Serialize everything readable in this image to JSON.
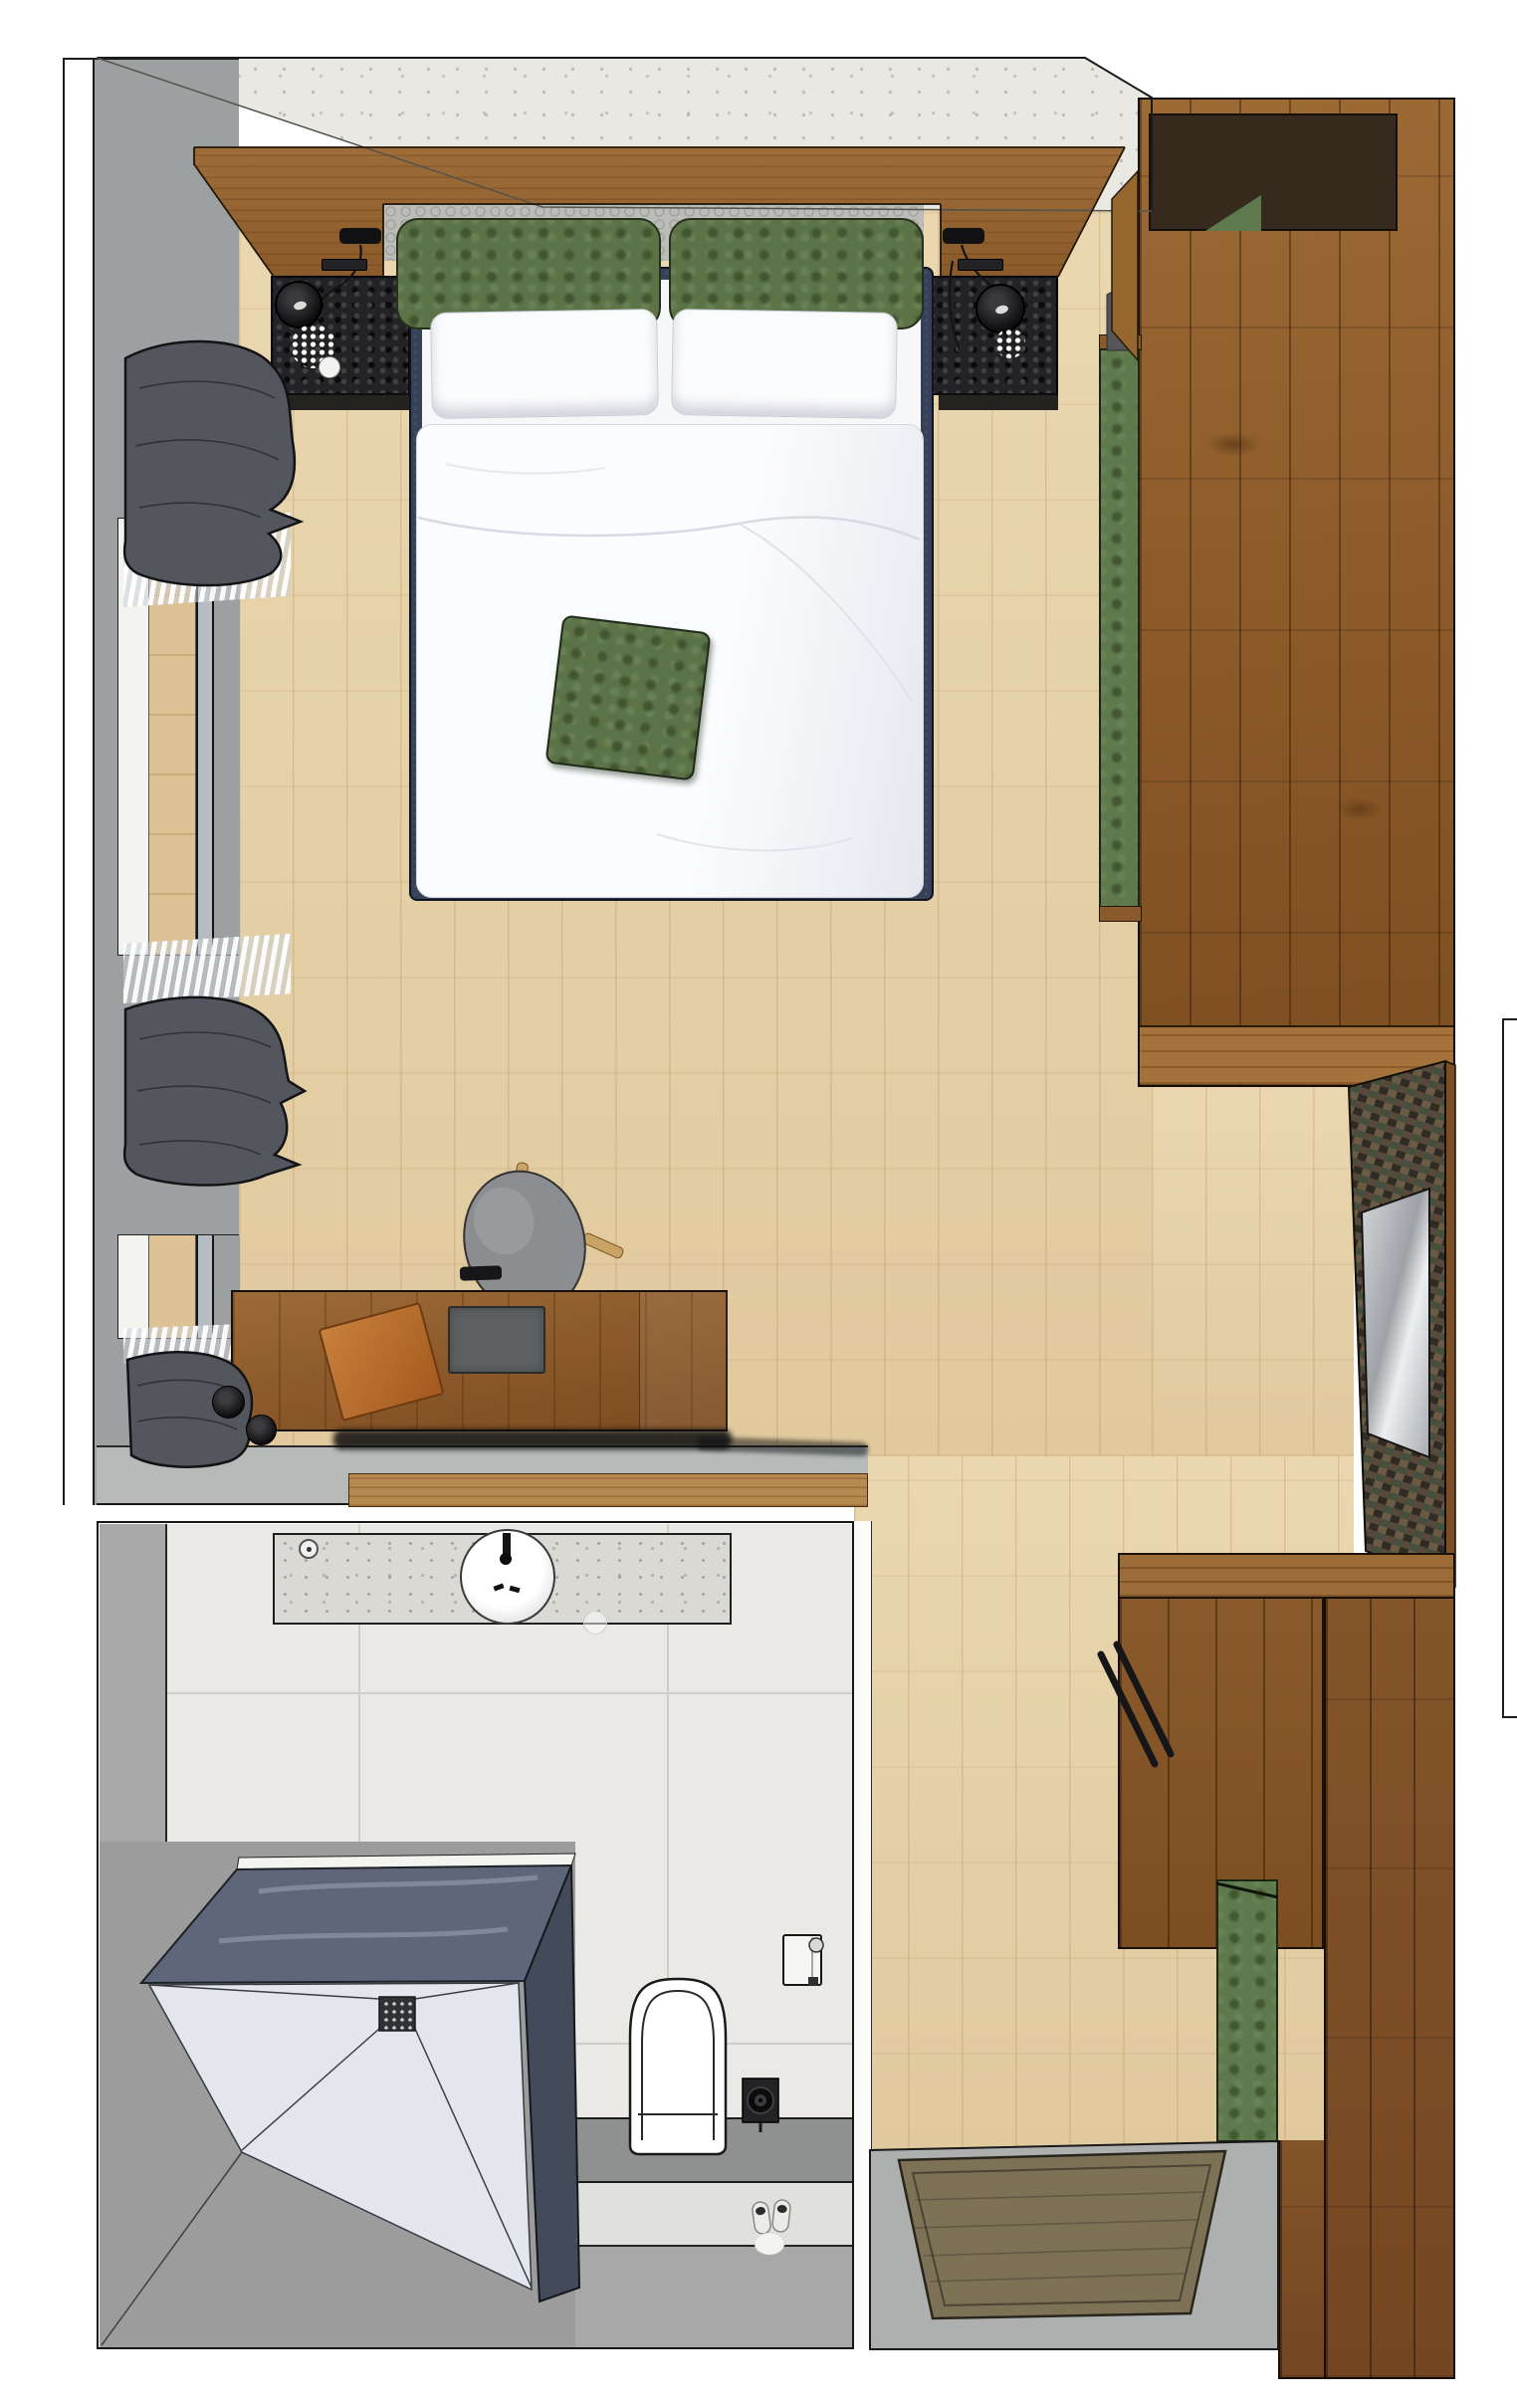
{
  "title": "hotel-guest-room-top-view-rendering",
  "colors": {
    "floor": "#e6d1a8",
    "concrete": "#eae8e2",
    "wall_gray": "#9da0a1",
    "outline": "#1c1c1c",
    "headboard_wood": "#96662f",
    "wardrobe_wood": "#91602f",
    "dark_wood": "#7a4c22",
    "desk_wood": "#8f5d2c",
    "coal": "#232326",
    "bed_frame": "#37425a",
    "linen_white": "#fbfcfd",
    "cushion_green": "#5c7347",
    "bench_green": "#5e7a4d",
    "carpet": "#bcbdb8",
    "curtain_gray": "#53565c",
    "tile": "#eae9e5",
    "grout": "#cfcec8",
    "vanity": "#dad9d4",
    "glass_back": "#586276",
    "glass_side": "#3e4556",
    "shower_floor": "#e3e7ed",
    "floor_gray": "#9b9c9b",
    "ledge_gray": "#8f9090",
    "band_light": "#e0e0dc",
    "entry_gray": "#aeb0af",
    "mat_olive": "#7d7156",
    "mirror": "#c7cacd",
    "orange_pad": "#b5682c",
    "chair_gray": "#8b8d90"
  },
  "scene": {
    "bedroom": {
      "label": "bedroom",
      "objects": [
        "headboard-wood-panel",
        "carpet-runner",
        "double-bed",
        "green-back-cushions",
        "white-pillows",
        "duvet",
        "green-throw-pillow",
        "nightstand-left",
        "nightstand-right",
        "bedside-lamp-left",
        "bedside-lamp-right",
        "reading-light-left",
        "reading-light-right",
        "power-socket",
        "window-left-upper",
        "window-left-lower",
        "sheer-curtain",
        "curtain-bundle-top",
        "curtain-bundle-middle",
        "curtain-bundle-bottom",
        "wardrobe",
        "bench-cushion-green",
        "desk",
        "desk-chair",
        "leather-desk-pad",
        "desk-tray",
        "remote-bar",
        "wall-hook-knobs",
        "half-wall",
        "window-sill-board"
      ]
    },
    "bathroom": {
      "label": "bathroom",
      "objects": [
        "vanity-counter",
        "washbasin",
        "faucet",
        "soap-dispenser",
        "tumbler",
        "walk-in-shower",
        "glass-screen",
        "floor-drain",
        "sloped-shower-floor",
        "wall-hung-toilet",
        "toilet-paper-holder",
        "toilet-brush",
        "slippers",
        "fluffy-bath-pompom",
        "tile-floor",
        "gray-wet-zone"
      ]
    },
    "entry": {
      "label": "entry-area",
      "objects": [
        "hallway-floor",
        "doormat",
        "entry-door-dark-wood",
        "hallway-cabinet",
        "towel-rail-handles",
        "green-niche-cushion",
        "mosaic-wall-panel",
        "mirror",
        "legend-box-cut-off"
      ]
    }
  }
}
